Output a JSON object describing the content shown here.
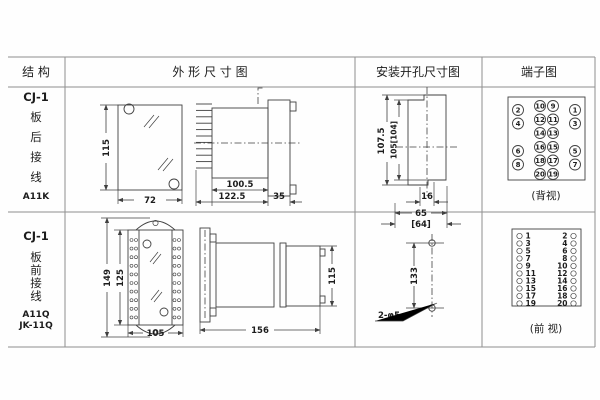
{
  "header": {
    "col1": "结 构",
    "col2": "外 形 尺 寸 图",
    "col3": "安装开孔尺寸图",
    "col4": "端子图"
  },
  "row1": {
    "structure": {
      "model": "CJ-1",
      "line1": "板",
      "line2": "后",
      "line3": "接",
      "line4": "线",
      "code": "A11K"
    },
    "outline": {
      "front_height": "115",
      "front_width": "72",
      "side_body_width": "100.5",
      "side_total_width": "122.5",
      "side_flange_width": "35"
    },
    "mounting": {
      "outer_height": "107.5",
      "inner_height": "105[104]",
      "slot_width": "16",
      "hole_span": "65",
      "hole_span_alt": "[64]"
    },
    "terminal": {
      "label": "(背视)",
      "mid_left": [
        "10",
        "12",
        "14",
        "16",
        "18",
        "20"
      ],
      "mid_right": [
        "9",
        "11",
        "13",
        "15",
        "17",
        "19"
      ],
      "outer_left": [
        "2",
        "4",
        "6",
        "8"
      ],
      "outer_right": [
        "1",
        "3",
        "5",
        "7"
      ]
    }
  },
  "row2": {
    "structure": {
      "model": "CJ-1",
      "line1": "板",
      "line2": "前",
      "line3": "接",
      "line4": "线",
      "code1": "A11Q",
      "code2": "JK-11Q"
    },
    "outline": {
      "front_outer_height": "149",
      "front_inner_height": "125",
      "front_width": "105",
      "side_width": "156",
      "side_height": "115"
    },
    "mounting": {
      "hole_spacing": "133",
      "hole_note": "2-φ5"
    },
    "terminal": {
      "label": "(前 视)",
      "left": [
        "1",
        "3",
        "5",
        "7",
        "9",
        "11",
        "13",
        "15",
        "17",
        "19"
      ],
      "right": [
        "2",
        "4",
        "6",
        "8",
        "10",
        "12",
        "14",
        "16",
        "18",
        "20"
      ]
    }
  }
}
